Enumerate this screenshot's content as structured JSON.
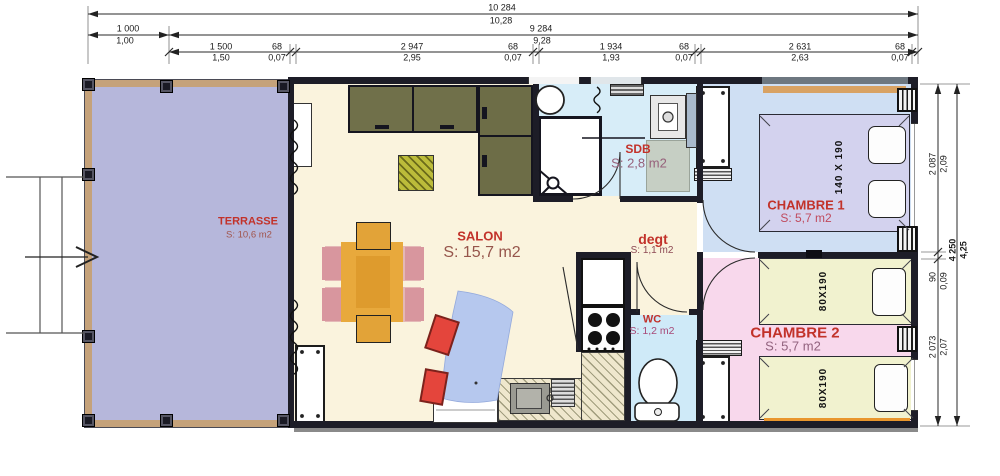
{
  "dims_top": {
    "overall": {
      "mm": "10 284",
      "m": "10,28"
    },
    "left": {
      "mm": "1 000",
      "m": "1,00"
    },
    "inner": {
      "mm": "9 284",
      "m": "9,28"
    },
    "segments": [
      {
        "mm": "1 500",
        "m": "1,50"
      },
      {
        "mm": "68",
        "m": "0,07"
      },
      {
        "mm": "2 947",
        "m": "2,95"
      },
      {
        "mm": "68",
        "m": "0,07"
      },
      {
        "mm": "1 934",
        "m": "1,93"
      },
      {
        "mm": "68",
        "m": "0,07"
      },
      {
        "mm": "2 631",
        "m": "2,63"
      },
      {
        "mm": "68",
        "m": "0,07"
      }
    ]
  },
  "dims_right": {
    "segments": [
      {
        "mm": "2 087",
        "m": "2,09"
      },
      {
        "mm": "90",
        "m": "0,09"
      },
      {
        "mm": "2 073",
        "m": "2,07"
      }
    ],
    "overall": {
      "mm": "4 250",
      "m": "4,25"
    }
  },
  "rooms": {
    "terrasse": {
      "name": "TERRASSE",
      "area": "S: 10,6 m2"
    },
    "salon": {
      "name": "SALON",
      "area": "S: 15,7 m2"
    },
    "sdb": {
      "name": "SDB",
      "area": "S: 2,8 m2"
    },
    "degt": {
      "name": "degt",
      "area": "S: 1,1 m2"
    },
    "wc": {
      "name": "WC",
      "area": "S: 1,2 m2"
    },
    "chambre1": {
      "name": "CHAMBRE 1",
      "area": "S: 5,7 m2",
      "bed_label": "140 X 190"
    },
    "chambre2": {
      "name": "CHAMBRE 2",
      "area": "S: 5,7 m2",
      "bed1_label": "80X190",
      "bed2_label": "80X190"
    }
  },
  "colors": {
    "wall": "#1d1d27",
    "terrasse_floor": "#b6b7db",
    "terrasse_frame": "#c5a27a",
    "salon_floor": "#faf3dd",
    "sdb_floor": "#d7edf8",
    "wc_floor": "#cfeaf8",
    "chambre1_floor": "#cfdff3",
    "chambre1_bed": "#d3d2ee",
    "chambre2_floor": "#f8d8ec",
    "chambre2_bed": "#f1f2cf",
    "cabinet_olive": "#6e6e49",
    "table_orange": "#e8a93c",
    "sofa_blue": "#b6c8ee",
    "cushion_red": "#e4453c",
    "bed_base_orange": "#e9962d",
    "label_red": "#c2322a"
  }
}
